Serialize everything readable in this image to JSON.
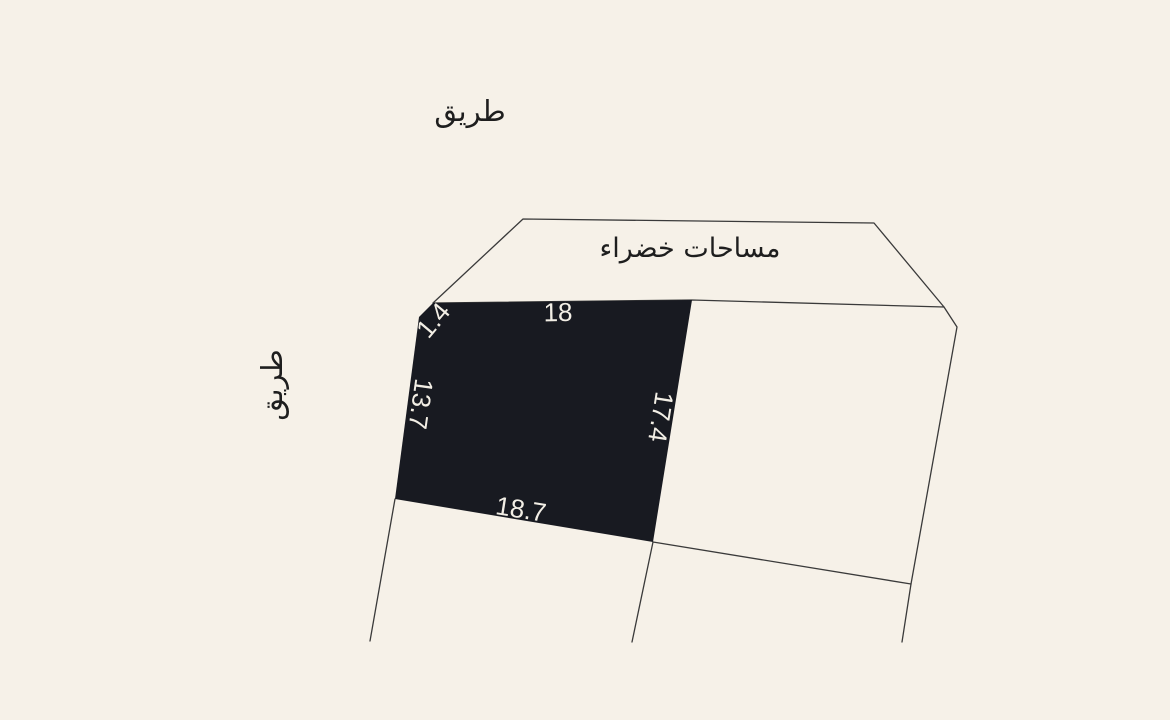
{
  "colors": {
    "background": "#f6f1e8",
    "plot_fill": "#181a21",
    "line": "#3a3a3a",
    "arabic_text": "#1e1e1e",
    "dimension_text": "#f2eee5"
  },
  "labels": {
    "road_top": "طريق",
    "road_left": "طريق",
    "green_spaces": "مساحات خضراء"
  },
  "plot": {
    "dimensions": {
      "corner": "1.4",
      "top": "18",
      "right": "17.4",
      "bottom": "18.7",
      "left": "13.7"
    }
  }
}
